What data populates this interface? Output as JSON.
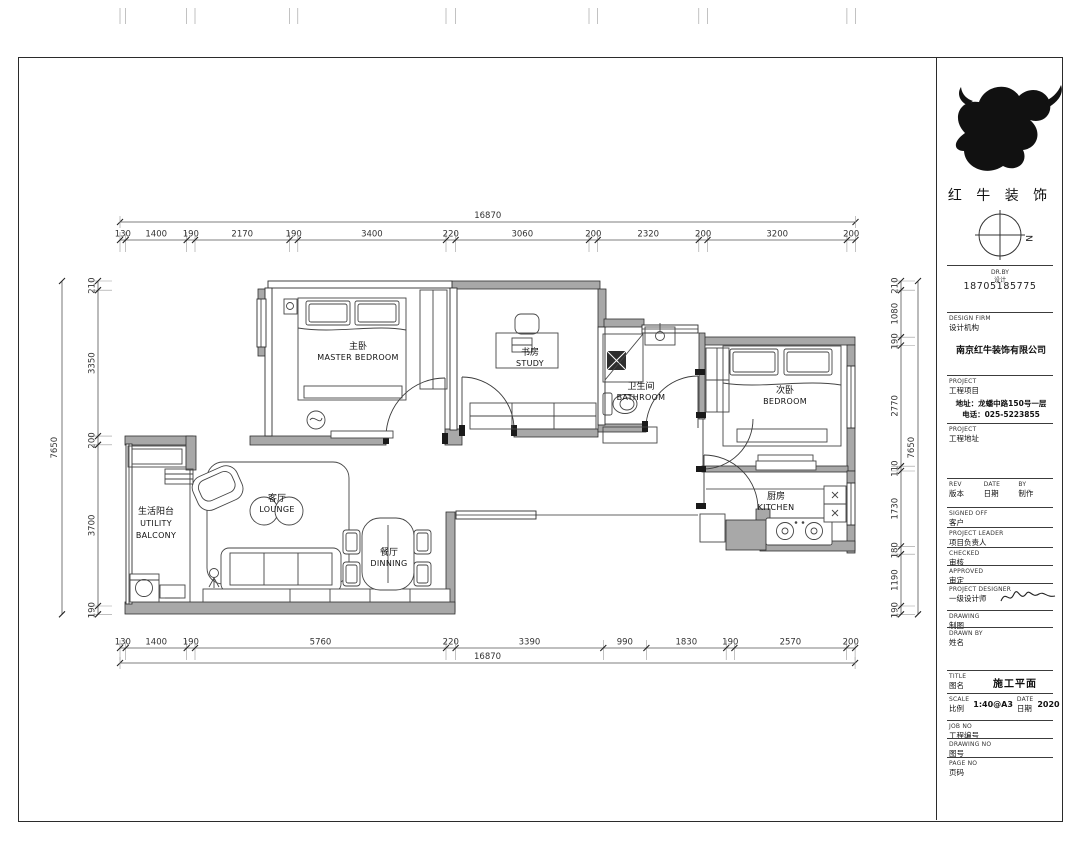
{
  "logo": {
    "company_cn": "红 牛 装 饰",
    "phone": "18705185775",
    "compass_n": "N"
  },
  "title_block": {
    "micro_en": "DR.BY",
    "micro_cn": "设计",
    "firm": {
      "en": "DESIGN FIRM",
      "cn": "设计机构",
      "value": "南京红牛装饰有限公司"
    },
    "project": {
      "en": "PROJECT",
      "cn": "工程项目",
      "address": "地址：龙蟠中路150号一层",
      "tel": "电话：025-5223855"
    },
    "site": {
      "en": "PROJECT",
      "cn": "工程地址"
    },
    "rev": {
      "c1en": "REV",
      "c1cn": "版本",
      "c2en": "DATE",
      "c2cn": "日期",
      "c3en": "BY",
      "c3cn": "制作"
    },
    "rows": [
      {
        "en": "SIGNED OFF",
        "cn": "客户"
      },
      {
        "en": "PROJECT LEADER",
        "cn": "项目负责人"
      },
      {
        "en": "CHECKED",
        "cn": "审核"
      },
      {
        "en": "APPROVED",
        "cn": "审定"
      },
      {
        "en": "PROJECT DESIGNER",
        "cn": "一级设计师"
      },
      {
        "en": "DRAWING",
        "cn": "制图"
      },
      {
        "en": "DRAWN BY",
        "cn": "姓名"
      }
    ],
    "title": {
      "en": "TITLE",
      "cn": "图名",
      "value": "施工平面"
    },
    "scale": {
      "en": "SCALE",
      "cn": "比例",
      "value": "1:40@A3",
      "date_en": "DATE",
      "date_cn": "日期",
      "date_value": "2020"
    },
    "job": {
      "en": "JOB NO",
      "cn": "工程编号"
    },
    "dwg": {
      "en": "DRAWING NO",
      "cn": "图号"
    },
    "page": {
      "en": "PAGE NO",
      "cn": "页码"
    }
  },
  "rooms": {
    "master": {
      "cn": "主卧",
      "en": "MASTER  BEDROOM"
    },
    "study": {
      "cn": "书房",
      "en": "STUDY"
    },
    "bathroom": {
      "cn": "卫生间",
      "en": "BATHROOM"
    },
    "bedroom": {
      "cn": "次卧",
      "en": "BEDROOM"
    },
    "kitchen": {
      "cn": "厨房",
      "en": "KITCHEN"
    },
    "lounge": {
      "cn": "客厅",
      "en": "LOUNGE"
    },
    "dining": {
      "cn": "餐厅",
      "en": "DINNING"
    },
    "balcony": {
      "cn": "生活阳台",
      "en1": "UTILITY",
      "en2": "BALCONY"
    }
  },
  "dims": {
    "top": {
      "overall": "16870",
      "values": [
        "130",
        "1400",
        "190",
        "2170",
        "190",
        "3400",
        "220",
        "3060",
        "200",
        "2320",
        "200",
        "3200",
        "200"
      ]
    },
    "bottom": {
      "overall": "16870",
      "values": [
        "130",
        "1400",
        "190",
        "5760",
        "220",
        "3390",
        "990",
        "1830",
        "190",
        "2570",
        "200"
      ]
    },
    "left": {
      "overall": "7650",
      "values": [
        "210",
        "3350",
        "200",
        "3700",
        "190"
      ]
    },
    "right": {
      "overall": "7650",
      "values": [
        "210",
        "1080",
        "190",
        "2770",
        "110",
        "1730",
        "180",
        "1190",
        "190"
      ]
    }
  }
}
